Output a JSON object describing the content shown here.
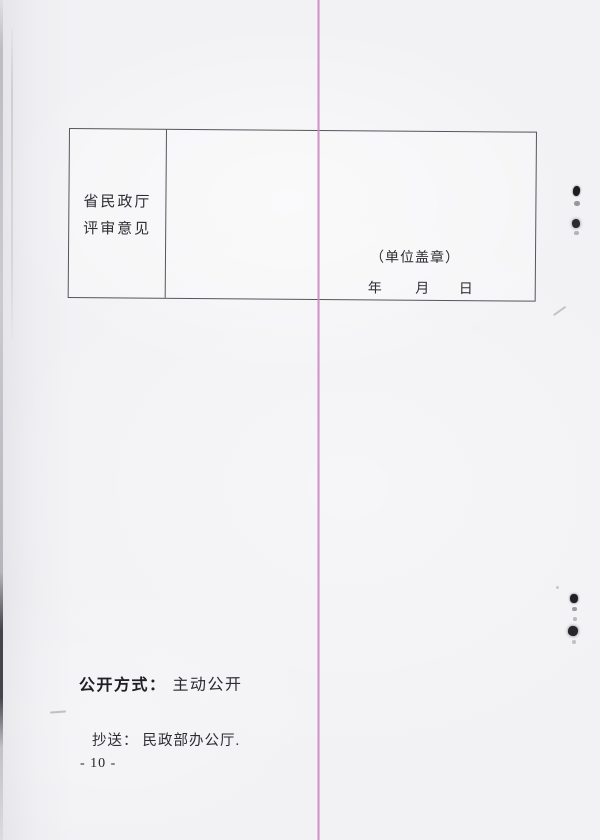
{
  "document": {
    "review_table": {
      "label_lines": [
        "省民政厅",
        "评审意见"
      ],
      "seal_note": "（单位盖章）",
      "date_parts": [
        "年",
        "月",
        "日"
      ]
    },
    "footer": {
      "disclosure_label": "公开方式：",
      "disclosure_value": "主动公开",
      "cc_label": "抄送：",
      "cc_value": "民政部办公厅.",
      "page_number": "- 10 -"
    }
  },
  "colors": {
    "paper": "#f2f1f4",
    "ink": "#2b2b30",
    "table-border": "#55555b",
    "fold-line": "#c985c2"
  }
}
